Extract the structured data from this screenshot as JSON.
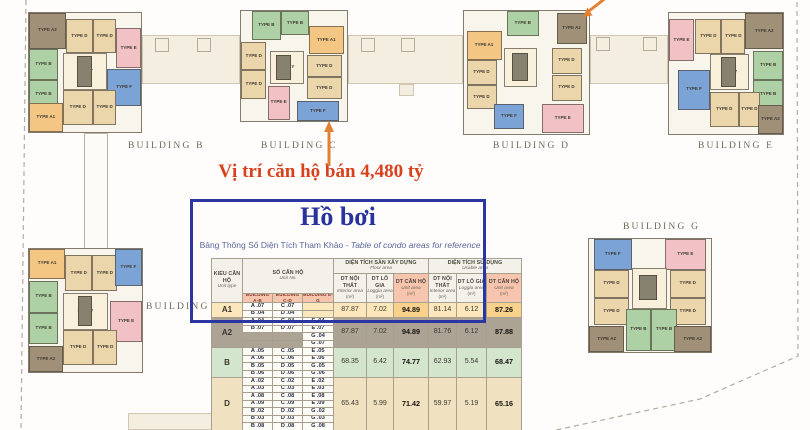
{
  "colors": {
    "accent_red": "#d8411e",
    "arrow_orange": "#e08136",
    "box_blue": "#2b36a3",
    "dash_gray": "#b2aca0",
    "title_blue": "#28339d",
    "subtitle_blue": "#5a679c"
  },
  "annotation": {
    "text": "Vị trí căn hộ bán 4,480 tỷ"
  },
  "info_box": {
    "title": "Hồ bơi",
    "subtitle_vi": "Bảng Thông Số Diện Tích Tham Khảo",
    "subtitle_en": "- Table of condo areas for reference"
  },
  "site": {
    "type_prefix": "TYPE",
    "lobby_label": "LOBBY",
    "unit_colors": {
      "A1": "#f3c783",
      "A2": "#9f9077",
      "B": "#aed0a5",
      "D": "#ebd5aa",
      "E": "#f2c1c5",
      "F": "#7ba3d5",
      "LOBBY": "#f8f0db",
      "CORE": "#87826f"
    },
    "buildings": [
      {
        "id": "b",
        "label": "BUILDING B",
        "x": 28,
        "y": 12,
        "w": 114,
        "h": 121,
        "lx": 128,
        "ly": 141,
        "units": [
          [
            "A2",
            0,
            0,
            33,
            30
          ],
          [
            "D",
            33,
            5,
            24,
            29
          ],
          [
            "D",
            57,
            5,
            21,
            29
          ],
          [
            "E",
            78,
            13,
            22,
            33
          ],
          [
            "B",
            0,
            30,
            26,
            26
          ],
          [
            "B",
            0,
            56,
            26,
            25
          ],
          [
            "LOBBY",
            30,
            34,
            40,
            31
          ],
          [
            "CORE",
            43,
            36,
            13,
            26
          ],
          [
            "F",
            70,
            47,
            30,
            31
          ],
          [
            "D",
            30,
            65,
            27,
            29
          ],
          [
            "D",
            57,
            65,
            21,
            29
          ],
          [
            "A1",
            0,
            76,
            30,
            24
          ]
        ]
      },
      {
        "id": "c",
        "label": "BUILDING C",
        "x": 240,
        "y": 10,
        "w": 108,
        "h": 112,
        "lx": 261,
        "ly": 141,
        "units": [
          [
            "B",
            10,
            0,
            28,
            26
          ],
          [
            "B",
            38,
            0,
            26,
            22
          ],
          [
            "A1",
            64,
            14,
            33,
            25
          ],
          [
            "D",
            0,
            28,
            24,
            26
          ],
          [
            "D",
            0,
            54,
            24,
            26
          ],
          [
            "LOBBY",
            27,
            36,
            32,
            30
          ],
          [
            "CORE",
            33,
            40,
            14,
            23
          ],
          [
            "D",
            62,
            40,
            33,
            20
          ],
          [
            "D",
            62,
            60,
            33,
            20
          ],
          [
            "E",
            25,
            68,
            21,
            31
          ],
          [
            "F",
            53,
            82,
            39,
            18
          ]
        ]
      },
      {
        "id": "d",
        "label": "BUILDING D",
        "x": 463,
        "y": 10,
        "w": 127,
        "h": 125,
        "lx": 493,
        "ly": 141,
        "units": [
          [
            "B",
            34,
            0,
            26,
            20
          ],
          [
            "A2",
            74,
            2,
            24,
            25
          ],
          [
            "A1",
            2,
            16,
            28,
            24
          ],
          [
            "D",
            2,
            40,
            24,
            20
          ],
          [
            "D",
            2,
            60,
            24,
            20
          ],
          [
            "LOBBY",
            32,
            30,
            26,
            32
          ],
          [
            "CORE",
            38,
            34,
            13,
            23
          ],
          [
            "D",
            70,
            30,
            24,
            21
          ],
          [
            "D",
            70,
            52,
            24,
            21
          ],
          [
            "F",
            24,
            76,
            24,
            20
          ],
          [
            "E",
            62,
            76,
            34,
            23
          ]
        ]
      },
      {
        "id": "e",
        "label": "BUILDING E",
        "x": 668,
        "y": 12,
        "w": 116,
        "h": 123,
        "lx": 698,
        "ly": 141,
        "units": [
          [
            "E",
            0,
            5,
            22,
            35
          ],
          [
            "D",
            23,
            5,
            23,
            29
          ],
          [
            "D",
            46,
            5,
            21,
            29
          ],
          [
            "A2",
            67,
            0,
            33,
            30
          ],
          [
            "B",
            74,
            31,
            26,
            24
          ],
          [
            "B",
            74,
            55,
            26,
            24
          ],
          [
            "LOBBY",
            36,
            34,
            34,
            30
          ],
          [
            "CORE",
            46,
            36,
            13,
            25
          ],
          [
            "F",
            8,
            47,
            28,
            33
          ],
          [
            "D",
            36,
            65,
            25,
            29
          ],
          [
            "D",
            61,
            65,
            19,
            29
          ],
          [
            "A2",
            78,
            76,
            22,
            24
          ]
        ]
      },
      {
        "id": "a",
        "label": "BUILDING A",
        "x": 28,
        "y": 248,
        "w": 115,
        "h": 125,
        "lx": 146,
        "ly": 302,
        "units": [
          [
            "A1",
            0,
            0,
            32,
            24
          ],
          [
            "D",
            32,
            5,
            24,
            29
          ],
          [
            "D",
            56,
            5,
            22,
            29
          ],
          [
            "F",
            76,
            0,
            24,
            30
          ],
          [
            "B",
            0,
            26,
            26,
            26
          ],
          [
            "B",
            0,
            52,
            26,
            25
          ],
          [
            "LOBBY",
            30,
            36,
            40,
            30
          ],
          [
            "CORE",
            43,
            38,
            13,
            25
          ],
          [
            "E",
            72,
            42,
            28,
            34
          ],
          [
            "D",
            30,
            66,
            27,
            28
          ],
          [
            "D",
            57,
            66,
            21,
            28
          ],
          [
            "A2",
            0,
            79,
            30,
            21
          ]
        ]
      },
      {
        "id": "g",
        "label": "BUILDING G",
        "x": 588,
        "y": 238,
        "w": 124,
        "h": 115,
        "lx": 623,
        "ly": 222,
        "units": [
          [
            "F",
            4,
            0,
            31,
            27
          ],
          [
            "E",
            62,
            0,
            34,
            27
          ],
          [
            "D",
            4,
            27,
            29,
            25
          ],
          [
            "D",
            66,
            27,
            30,
            25
          ],
          [
            "D",
            4,
            52,
            29,
            24
          ],
          [
            "D",
            66,
            52,
            30,
            24
          ],
          [
            "LOBBY",
            35,
            26,
            29,
            36
          ],
          [
            "CORE",
            41,
            32,
            15,
            22
          ],
          [
            "B",
            30,
            62,
            21,
            37
          ],
          [
            "B",
            51,
            62,
            21,
            37
          ],
          [
            "A2",
            0,
            77,
            29,
            23
          ],
          [
            "A2",
            70,
            77,
            30,
            23
          ]
        ]
      }
    ],
    "corridors": [
      [
        142,
        35,
        98,
        49
      ],
      [
        348,
        35,
        115,
        49
      ],
      [
        399,
        84,
        15,
        12
      ],
      [
        590,
        35,
        78,
        49
      ],
      [
        128,
        413,
        106,
        17
      ]
    ],
    "connectors": [
      [
        84,
        133,
        24,
        116
      ]
    ],
    "squares": [
      [
        155,
        38
      ],
      [
        197,
        38
      ],
      [
        361,
        38
      ],
      [
        401,
        38
      ],
      [
        596,
        37
      ],
      [
        643,
        37
      ]
    ]
  },
  "table": {
    "headers": {
      "unit_type": {
        "vi": "KIỂU CĂN HỘ",
        "en": "Unit type"
      },
      "unit_no": {
        "vi": "SỐ CĂN HỘ",
        "en": "Unit No."
      },
      "buildings": [
        "BUILDING A-B",
        "BUILDING C-D",
        "BUILDING E-G"
      ],
      "floor_area": {
        "vi": "DIỆN TÍCH SÀN XÂY DỰNG",
        "en": "Floor area"
      },
      "usable_area": {
        "vi": "DIỆN TÍCH SỬ DỤNG",
        "en": "Usable area"
      },
      "sub": [
        {
          "vi": "DT NỘI THẤT",
          "en": "Interior area",
          "unit": "(m²)"
        },
        {
          "vi": "DT LÔ GIA",
          "en": "Loggia area",
          "unit": "(m²)"
        },
        {
          "vi": "DT CĂN HỘ",
          "en": "Unit area",
          "unit": "(m²)"
        }
      ]
    },
    "rows": [
      {
        "type": "A1",
        "bg": "#fbe7bb",
        "hl": "#f8d28c",
        "units": [
          [
            "A .07",
            "C .07",
            ""
          ],
          [
            "B .04",
            "D .04",
            ""
          ]
        ],
        "floor": [
          "87.87",
          "7.02",
          "94.89"
        ],
        "usable": [
          "81.14",
          "6.12",
          "87.26"
        ]
      },
      {
        "type": "A2",
        "bg": "#aca395",
        "hl": "#aca395",
        "units": [
          [
            "A .04",
            "C .04",
            "E .04"
          ],
          [
            "B .07",
            "D .07",
            "E .07"
          ],
          [
            "",
            "",
            "G .04"
          ],
          [
            "",
            "",
            "G .07"
          ]
        ],
        "floor": [
          "87.87",
          "7.02",
          "94.89"
        ],
        "usable": [
          "81.76",
          "6.12",
          "87.88"
        ]
      },
      {
        "type": "B",
        "bg": "#d3e5cd",
        "hl": "#d3e5cd",
        "units": [
          [
            "A .05",
            "C .05",
            "E .05"
          ],
          [
            "A .06",
            "C .06",
            "E .06"
          ],
          [
            "B .05",
            "D .05",
            "G .05"
          ],
          [
            "B .06",
            "D .06",
            "G .06"
          ]
        ],
        "floor": [
          "68.35",
          "6.42",
          "74.77"
        ],
        "usable": [
          "62.93",
          "5.54",
          "68.47"
        ]
      },
      {
        "type": "D",
        "bg": "#f0e1c0",
        "hl": "#f0e1c0",
        "units": [
          [
            "A .02",
            "C .02",
            "E .02"
          ],
          [
            "A .03",
            "C .03",
            "E .03"
          ],
          [
            "A .08",
            "C .08",
            "E .08"
          ],
          [
            "A .09",
            "C .09",
            "E .09"
          ],
          [
            "B .02",
            "D .02",
            "G .02"
          ],
          [
            "B .03",
            "D .03",
            "G .03"
          ],
          [
            "B .08",
            "D .08",
            "G .08"
          ]
        ],
        "floor": [
          "65.43",
          "5.99",
          "71.42"
        ],
        "usable": [
          "59.97",
          "5.19",
          "65.16"
        ]
      }
    ]
  }
}
